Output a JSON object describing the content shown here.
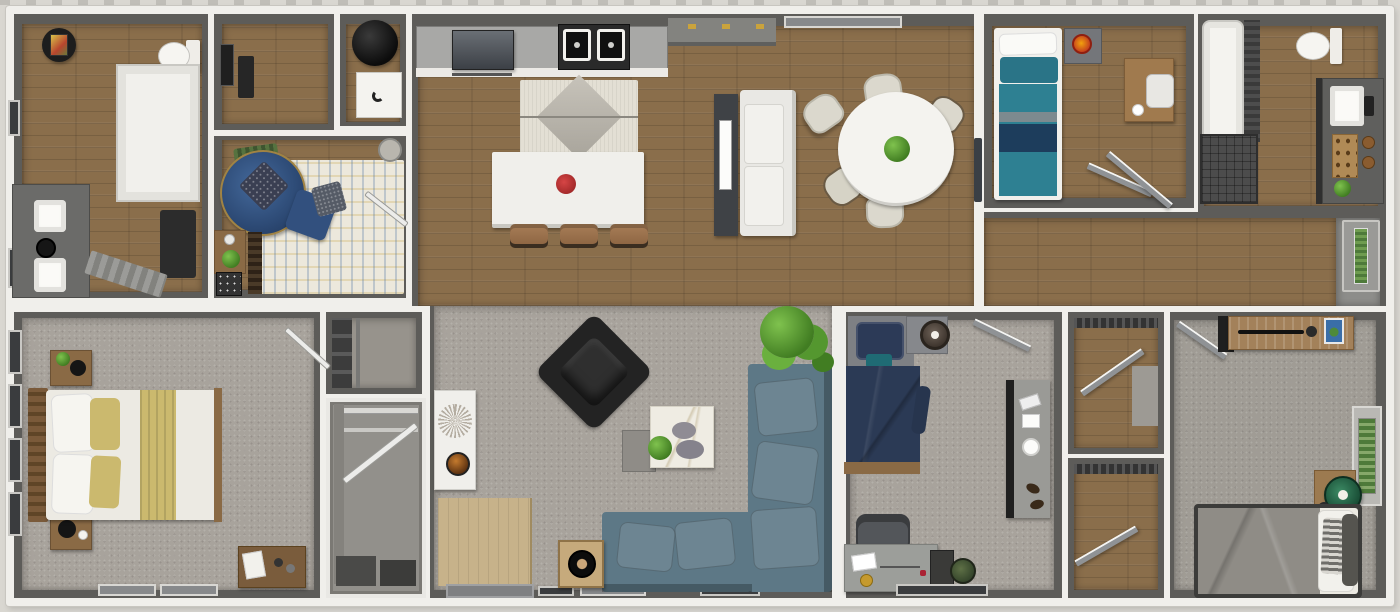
{
  "scene": {
    "title": "3D top-down dollhouse floor plan rendering of a single-wide home",
    "style": "overhead furnished render, no visible text"
  },
  "palette": {
    "outside": "#d9d7d1",
    "wall_white": "#f0efeb",
    "wall_gray": "#5d5c59",
    "wood_floor": "#8a6e4b",
    "entry_wood": "#c7b28a",
    "carpet": "#a8a39c",
    "teal_bed": "#2e8092",
    "teal_pillow": "#2a7487",
    "navy_band": "#1d3d5c",
    "navy_bed": "#2b3a55",
    "navy_headboard": "#2c3a57",
    "round_chair_navy": "#35567f",
    "sectional_blue": "#5d7886",
    "tan_blanket": "#cbb96e",
    "black_chair": "#232323",
    "white_furniture": "#efede8",
    "cream_rug": "#ece8dc",
    "kitchen_rug": "#e3dfd4",
    "plant_green": "#4e9a35",
    "red_flowers": "#c03434",
    "orange_lamp": "#e8930c",
    "gray_blanket": "#8f8c86",
    "green_chair": "#2e7a57",
    "wood_furniture": "#9c7b52",
    "counter_gray": "#a8a8a6",
    "dark_mat": "#2c2c2c",
    "green_glass": "#4e7a3a",
    "blue_book": "#3a6ea8"
  },
  "rooms": [
    {
      "id": "primary-bathroom",
      "label": "Primary Bathroom",
      "floor": "wood"
    },
    {
      "id": "front-hallway",
      "label": "Hallway",
      "floor": "wood"
    },
    {
      "id": "utility-room",
      "label": "Utility Room",
      "floor": "wood"
    },
    {
      "id": "den",
      "label": "Den / Sitting Room",
      "floor": "wood"
    },
    {
      "id": "kitchen-dining",
      "label": "Kitchen & Dining Great Room",
      "floor": "wood"
    },
    {
      "id": "bedroom-teal",
      "label": "Bedroom 2",
      "floor": "wood"
    },
    {
      "id": "bathroom-2",
      "label": "Bathroom 2",
      "floor": "wood"
    },
    {
      "id": "rear-hallway",
      "label": "Rear Hallway",
      "floor": "wood"
    },
    {
      "id": "back-entry",
      "label": "Back Entry",
      "floor": "gray"
    },
    {
      "id": "primary-bedroom",
      "label": "Primary Bedroom",
      "floor": "carpet"
    },
    {
      "id": "closet-upper",
      "label": "Closet",
      "floor": "carpet"
    },
    {
      "id": "walk-in-closet",
      "label": "Walk-in Closet",
      "floor": "carpet"
    },
    {
      "id": "living-room",
      "label": "Living Room",
      "floor": "carpet"
    },
    {
      "id": "bedroom-3",
      "label": "Bedroom 3",
      "floor": "carpet"
    },
    {
      "id": "closet-a",
      "label": "Closet",
      "floor": "wood"
    },
    {
      "id": "closet-b",
      "label": "Closet",
      "floor": "wood"
    },
    {
      "id": "bedroom-4",
      "label": "Bedroom 4",
      "floor": "carpet"
    }
  ],
  "furniture": {
    "dining_table": "Round dining table with centerpiece plant",
    "dining_chairs": "Dining chair",
    "kitchen_island": "Kitchen island with flowers",
    "stool": "Counter stool",
    "range_hood": "Range hood and cooktop",
    "kitchen_sink": "Double-basin kitchen sink",
    "sideboard": "Sideboard with brass pulls",
    "loveseat": "White loveseat",
    "media_console": "TV console",
    "kitchen_rug": "Diamond-pattern rug",
    "round_chair": "Round tufted lounge chair",
    "den_rug": "Cream plaid area rug",
    "water_heater": "Water heater",
    "washer": "Washer",
    "double_vanity": "Double-sink vanity",
    "shower": "Walk-in shower",
    "toilet": "Toilet",
    "bathtub": "Bathtub",
    "tiled_shower": "Tiled shower",
    "vanity_2": "Vanity with sink",
    "teal_bed": "Bed with teal bedding",
    "desk": "Desk with chair",
    "nightstand": "Nightstand",
    "primary_bed": "Primary bed with tan and white bedding",
    "dresser": "Dresser",
    "sectional": "L-shaped sectional sofa",
    "lounge_chair": "Black lounge chair",
    "coffee_table": "Nesting coffee tables",
    "floor_plant": "Potted floor plant",
    "speaker": "Floor speaker",
    "accent_cabinet": "Accent cabinet with decor",
    "front_door": "Front entry",
    "back_door": "Back door with glass insert",
    "navy_bed": "Bed with navy bedding",
    "office_chair": "Office chair",
    "waste_bin": "Waste bin",
    "gray_bed": "Bed with gray bedding",
    "bench_console": "Wood console with decor",
    "green_chair": "Green round chair"
  }
}
